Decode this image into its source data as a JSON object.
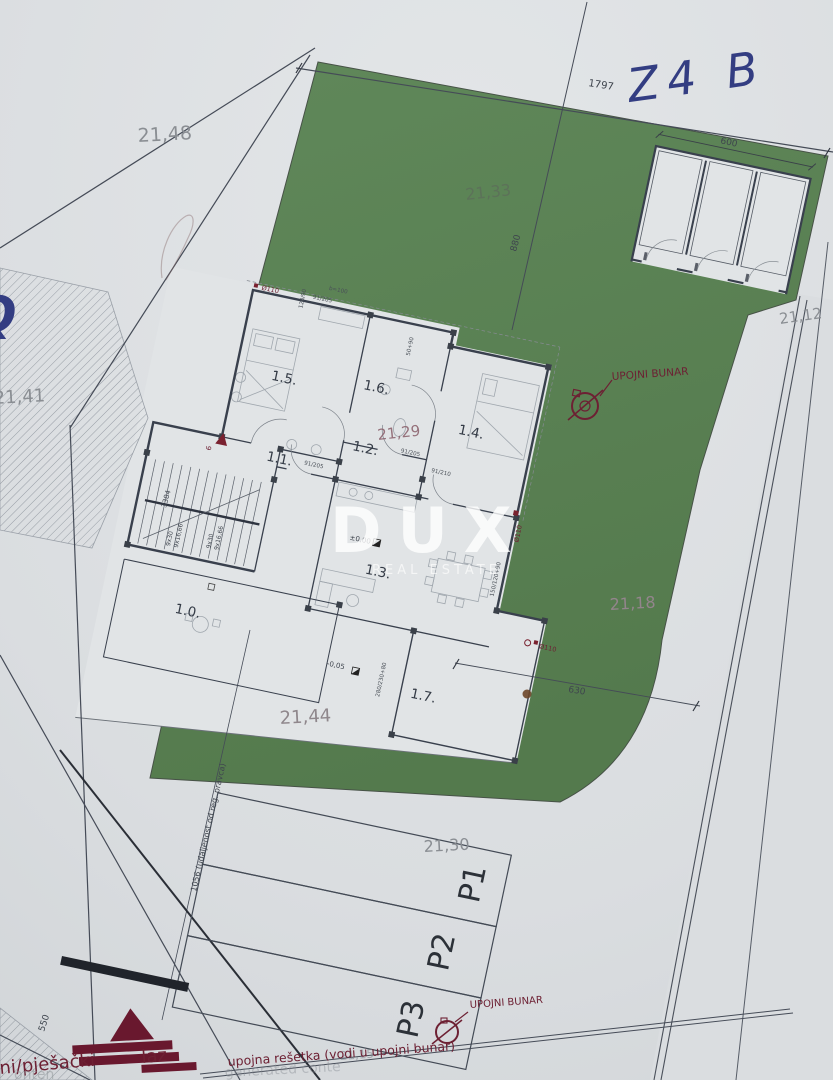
{
  "scene": {
    "type": "architectural site plan photo"
  },
  "colors": {
    "paper": "#dfe2e5",
    "grass": "#5b8153",
    "wall": "#3a4150",
    "annotation_red": "#6d2033",
    "handwriting_blue": "#333d82",
    "elevation_gray": "#8a8e93",
    "watermark_white": "rgba(255,255,255,0.8)"
  },
  "rooms": {
    "r10": "1.0.",
    "r11": "1.1.",
    "r12": "1.2.",
    "r13": "1.3.",
    "r14": "1.4.",
    "r15": "1.5.",
    "r16": "1.6.",
    "r17": "1.7."
  },
  "elevations": {
    "e2148": "21,48",
    "e2141": "21,41",
    "e2133": "21,33",
    "e2129": "21,29",
    "e2118": "21,18",
    "e2144": "21,44",
    "e2130": "21,30",
    "e2112": "21,12",
    "e2115": "21,15"
  },
  "dimensions": {
    "d1797": "1797",
    "d880": "880",
    "d600": "600",
    "d630": "630",
    "d550": "550",
    "d3384": "3384",
    "d1056": "1056 (udaljenost od reg. pravca)",
    "stairs_a": "9x30",
    "stairs_b": "9x16,66",
    "door_91_205": "91/205",
    "door_91_210": "91/210",
    "door_b100": "b=100",
    "d120_90": "120/90",
    "d50_90": "50+90",
    "d150_120_90": "150/120+90",
    "d280_230_80": "280/230+80"
  },
  "annotations": {
    "upojni_bunar": "UPOJNI BUNAR",
    "upojna_resetka": "upojna rešetka (vodi u upojni bunar)",
    "ulaz_left": "ni/pješački",
    "ulaz_right": "laz",
    "phi110": "Ø110",
    "level_zero": "±0,00",
    "level_minus": "-0,05",
    "entry_count": "6",
    "p1": "P1",
    "p2": "P2",
    "p3": "P3"
  },
  "handwriting": {
    "plot_code": "Z4 B",
    "margin_glyph": "Q"
  },
  "watermark": {
    "brand": "DUX",
    "subtitle": "REAL ESTATE"
  },
  "faint_marks": {
    "w1": "generated conte",
    "w2": "onten"
  }
}
